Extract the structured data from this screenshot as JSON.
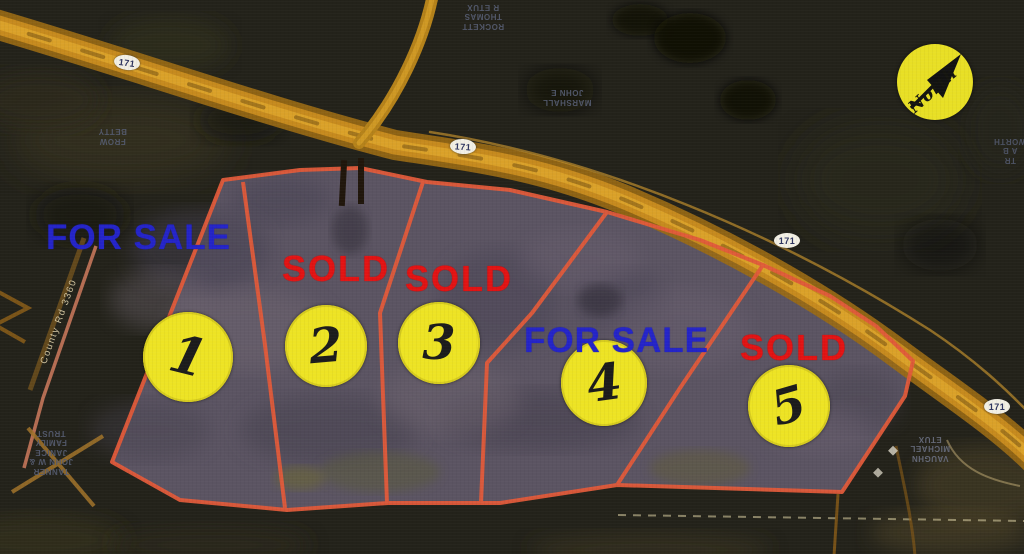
{
  "map": {
    "type": "aerial-plat-land-sale-map",
    "north_label": "North",
    "route_number": "171",
    "road_label": "County Rd 3360",
    "lots": [
      {
        "number": "1",
        "status": "FOR SALE",
        "status_color": "#2424c8"
      },
      {
        "number": "2",
        "status": "SOLD",
        "status_color": "#e21313"
      },
      {
        "number": "3",
        "status": "SOLD",
        "status_color": "#e21313"
      },
      {
        "number": "4",
        "status": "FOR SALE",
        "status_color": "#2424c8"
      },
      {
        "number": "5",
        "status": "SOLD",
        "status_color": "#e21313"
      }
    ],
    "colors": {
      "for_sale_text": "#2424c8",
      "sold_text": "#e21313",
      "lot_boundary": "#e05a3a",
      "lot_marker": "#ede324",
      "highway": "#c68a1e",
      "parcel_ground": "#5b5462"
    },
    "owner_labels": {
      "top_center": "ROCKETT\nTHOMAS\nR ETUX",
      "upper_middle": "MARSHALL\nJOHN E",
      "left": "FROW\nBETTY",
      "bottom_left": "TANNER\nJOHN W &\nJANICE\nFAMILY\nTRUST",
      "bottom_right": "VAUGHN\nMICHAEL\nETUX",
      "right_edge": "TR\nA B\nWORTH"
    }
  }
}
